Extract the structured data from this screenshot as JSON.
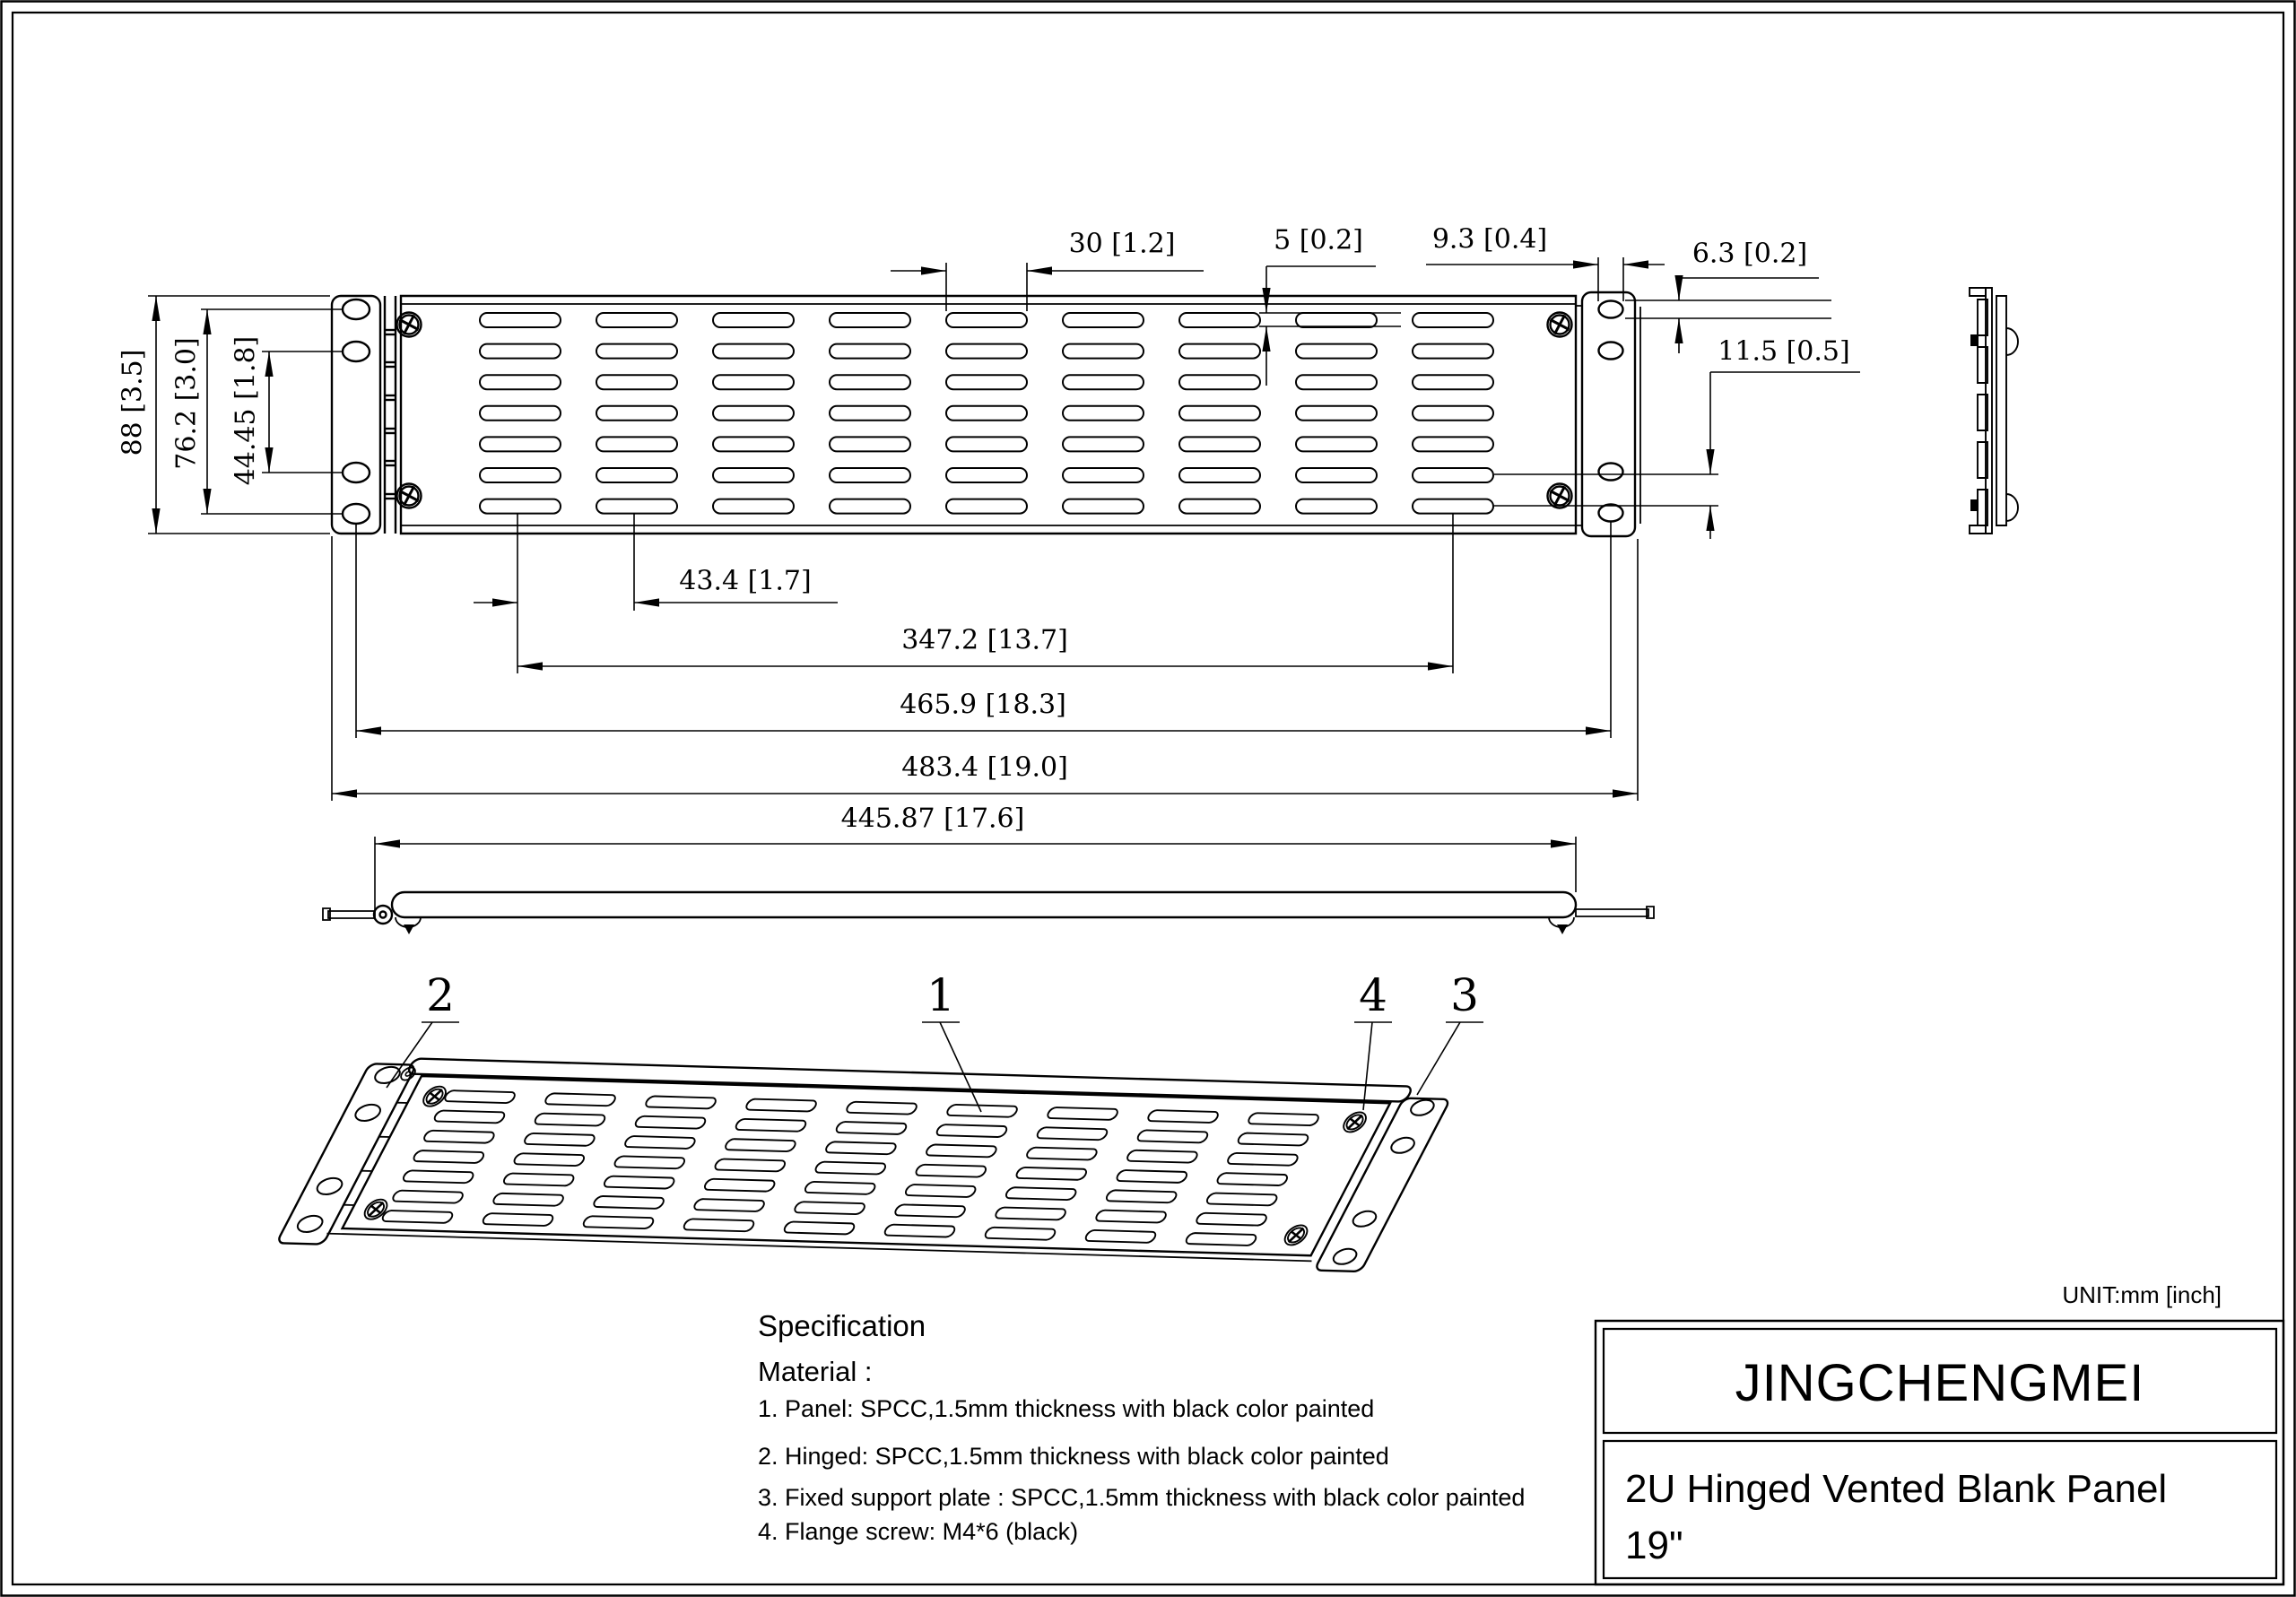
{
  "page": {
    "unit_note": "UNIT:mm [inch]"
  },
  "title_block": {
    "brand": "JINGCHENGMEI",
    "product_name": "2U Hinged Vented Blank Panel",
    "product_size": "19\""
  },
  "dimensions": {
    "slot_width": "30 [1.2]",
    "slot_height": "5 [0.2]",
    "ear_hole_width": "9.3 [0.4]",
    "ear_hole_height": "6.3 [0.2]",
    "slot_row_pitch": "11.5 [0.5]",
    "panel_height": "88 [3.5]",
    "hinge_hole_span_outer": "76.2 [3.0]",
    "hinge_hole_span_inner": "44.45 [1.8]",
    "slot_col_pitch": "43.4 [1.7]",
    "slot_span": "347.2 [13.7]",
    "mount_hole_span": "465.9 [18.3]",
    "overall_width": "483.4 [19.0]",
    "body_width": "445.87 [17.6]"
  },
  "callouts": {
    "panel": "1",
    "hinge": "2",
    "support_plate": "3",
    "flange_screw": "4"
  },
  "specification": {
    "heading": "Specification",
    "subheading": "Material :",
    "items": [
      "1.  Panel: SPCC,1.5mm thickness with black color painted",
      "2.  Hinged: SPCC,1.5mm thickness with black color painted",
      "3.  Fixed support plate : SPCC,1.5mm thickness with black color painted",
      "4.  Flange screw: M4*6 (black)"
    ]
  },
  "colors": {
    "ink": "#000000",
    "paper": "#ffffff"
  }
}
